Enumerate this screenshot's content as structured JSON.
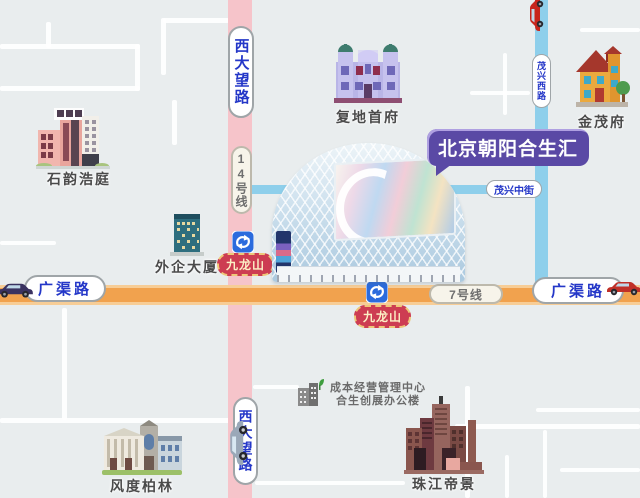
{
  "title": {
    "label": "北京朝阳合生汇"
  },
  "roads": {
    "xidawanglu_top": "西大望路",
    "xidawanglu_bottom": "西大望路",
    "maoxingxilu": "茂兴西路",
    "maoxingzhongjie": "茂兴中街",
    "guangqulu_left": "广渠路",
    "guangqulu_right": "广渠路"
  },
  "metro": {
    "line14_label": "14号线",
    "line7_label": "7号线",
    "station_jiulongshan_1": "九龙山",
    "station_jiulongshan_2": "九龙山"
  },
  "places": {
    "shiyunhaoting": "石韵浩庭",
    "fudishoufu": "复地首府",
    "jinmaofu": "金茂府",
    "waiqidasha": "外企大厦",
    "fengdubolin": "风度柏林",
    "zhujiangdijing": "珠江帝景",
    "office_line1": "成本经营管理中心",
    "office_line2": "合生创展办公楼"
  },
  "colors": {
    "background": "#E9EDEE",
    "road_pink": "#F6C4CA",
    "road_blue": "#8ECFEB",
    "road_orange": "#F1A24E",
    "road_label_text": "#2437C8",
    "title_bubble": "#5A49A5",
    "station_pill_bg": "#CD3D52",
    "station_pill_text": "#FCEFC5",
    "metro_icon_blue": "#2B6BDD"
  }
}
